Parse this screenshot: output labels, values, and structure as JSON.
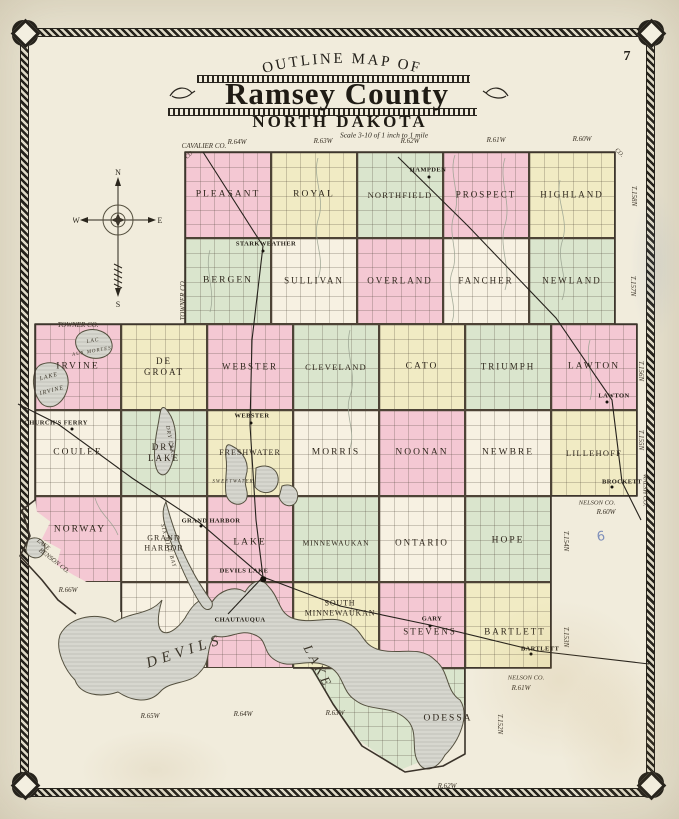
{
  "header": {
    "page_number": "7",
    "arc_title": "OUTLINE MAP OF",
    "title": "Ramsey County",
    "subtitle": "NORTH DAKOTA",
    "scale": "Scale 3-10 of 1 inch to 1 mile"
  },
  "compass": {
    "north": "N",
    "south": "S",
    "east": "E",
    "west": "W"
  },
  "colors": {
    "pink": "#f4c8d3",
    "yellow": "#f1ebc4",
    "green": "#dae5cd",
    "cream": "#f7f1e2",
    "lake_fill": "#d7d7cf",
    "lake_edge": "#54503f",
    "rail": "#26221c",
    "creek": "#96a08e",
    "boundary": "#3a332a",
    "ink": "#2f271c",
    "pencil_blue": "#6b7fb5"
  },
  "clips": {
    "norway": "polygon(0% 0%,100% 0%,100% 100%,60% 100%,45% 92%,25% 80%,30% 62%,8% 50%,18% 30%,2% 18%)",
    "odessa": "polygon(0% 0%,100% 0%,100% 35%,84% 84%,58% 100%,32% 71%,13% 31%)"
  },
  "townships": [
    {
      "n": "PLEASANT",
      "x": 185,
      "y": 152,
      "w": 86,
      "h": 86,
      "c": "pink"
    },
    {
      "n": "ROYAL",
      "x": 271,
      "y": 152,
      "w": 86,
      "h": 86,
      "c": "yellow"
    },
    {
      "n": "NORTHFIELD",
      "x": 357,
      "y": 152,
      "w": 86,
      "h": 86,
      "c": "green",
      "fs": 8.5,
      "sp": 1.2
    },
    {
      "n": "PROSPECT",
      "x": 443,
      "y": 152,
      "w": 86,
      "h": 86,
      "c": "pink",
      "fs": 9
    },
    {
      "n": "HIGHLAND",
      "x": 529,
      "y": 152,
      "w": 86,
      "h": 86,
      "c": "yellow",
      "fs": 9
    },
    {
      "n": "BERGEN",
      "x": 185,
      "y": 238,
      "w": 86,
      "h": 86,
      "c": "green"
    },
    {
      "n": "SULLIVAN",
      "x": 271,
      "y": 238,
      "w": 86,
      "h": 86,
      "c": "cream",
      "fs": 9
    },
    {
      "n": "OVERLAND",
      "x": 357,
      "y": 238,
      "w": 86,
      "h": 86,
      "c": "pink",
      "fs": 9
    },
    {
      "n": "FANCHER",
      "x": 443,
      "y": 238,
      "w": 86,
      "h": 86,
      "c": "cream",
      "fs": 9
    },
    {
      "n": "NEWLAND",
      "x": 529,
      "y": 238,
      "w": 86,
      "h": 86,
      "c": "green",
      "fs": 9
    },
    {
      "n": "IRVINE",
      "x": 35,
      "y": 324,
      "w": 86,
      "h": 86,
      "c": "pink"
    },
    {
      "n": "DE GROAT",
      "x": 121,
      "y": 324,
      "w": 86,
      "h": 86,
      "c": "yellow",
      "fs": 9
    },
    {
      "n": "WEBSTER",
      "x": 207,
      "y": 324,
      "w": 86,
      "h": 86,
      "c": "pink",
      "fs": 9
    },
    {
      "n": "CLEVELAND",
      "x": 293,
      "y": 324,
      "w": 86,
      "h": 86,
      "c": "green",
      "fs": 8.5,
      "sp": 1.2
    },
    {
      "n": "CATO",
      "x": 379,
      "y": 324,
      "w": 86,
      "h": 86,
      "c": "yellow"
    },
    {
      "n": "TRIUMPH",
      "x": 465,
      "y": 324,
      "w": 86,
      "h": 86,
      "c": "green",
      "fs": 9
    },
    {
      "n": "LAWTON",
      "x": 551,
      "y": 324,
      "w": 86,
      "h": 86,
      "c": "pink"
    },
    {
      "n": "COULEE",
      "x": 35,
      "y": 410,
      "w": 86,
      "h": 86,
      "c": "cream"
    },
    {
      "n": "DRY LAKE",
      "x": 121,
      "y": 410,
      "w": 86,
      "h": 86,
      "c": "green",
      "fs": 9
    },
    {
      "n": "FRESHWATER",
      "x": 207,
      "y": 410,
      "w": 86,
      "h": 86,
      "c": "yellow",
      "fs": 8,
      "sp": 1
    },
    {
      "n": "MORRIS",
      "x": 293,
      "y": 410,
      "w": 86,
      "h": 86,
      "c": "cream"
    },
    {
      "n": "NOONAN",
      "x": 379,
      "y": 410,
      "w": 86,
      "h": 86,
      "c": "pink"
    },
    {
      "n": "NEWBRE",
      "x": 465,
      "y": 410,
      "w": 86,
      "h": 86,
      "c": "cream"
    },
    {
      "n": "LILLEHOFF",
      "x": 551,
      "y": 410,
      "w": 86,
      "h": 86,
      "c": "yellow",
      "fs": 8.5,
      "sp": 1.2
    },
    {
      "n": "NORWAY",
      "x": 35,
      "y": 496,
      "w": 86,
      "h": 86,
      "c": "pink",
      "clip": "norway",
      "lx": 80,
      "ly": 530
    },
    {
      "n": "GRAND HARBOR",
      "x": 121,
      "y": 496,
      "w": 86,
      "h": 86,
      "c": "cream",
      "fs": 8,
      "sp": 1,
      "ly": 543
    },
    {
      "n": "LAKE",
      "x": 207,
      "y": 496,
      "w": 86,
      "h": 86,
      "c": "pink",
      "ly": 543
    },
    {
      "n": "MINNEWAUKAN",
      "x": 293,
      "y": 496,
      "w": 86,
      "h": 86,
      "c": "green",
      "fs": 7.5,
      "sp": 0.8,
      "ly": 543
    },
    {
      "n": "ONTARIO",
      "x": 379,
      "y": 496,
      "w": 86,
      "h": 86,
      "c": "cream",
      "fs": 9,
      "ly": 543
    },
    {
      "n": "HOPE",
      "x": 465,
      "y": 496,
      "w": 86,
      "h": 86,
      "c": "green",
      "ly": 541
    },
    {
      "n": "",
      "x": 121,
      "y": 582,
      "w": 86,
      "h": 86,
      "c": "cream"
    },
    {
      "n": "",
      "x": 207,
      "y": 582,
      "w": 86,
      "h": 86,
      "c": "pink"
    },
    {
      "n": "SOUTH\nMINNEWAUKAN",
      "x": 293,
      "y": 582,
      "w": 86,
      "h": 86,
      "c": "yellow",
      "fs": 8,
      "sp": 0.8,
      "lx": 340,
      "ly": 608
    },
    {
      "n": "STEVENS",
      "x": 379,
      "y": 582,
      "w": 86,
      "h": 86,
      "c": "pink",
      "fs": 9,
      "lx": 430,
      "ly": 632
    },
    {
      "n": "BARTLETT",
      "x": 465,
      "y": 582,
      "w": 86,
      "h": 86,
      "c": "yellow",
      "fs": 9,
      "lx": 515,
      "ly": 632
    },
    {
      "n": "ODESSA",
      "x": 310,
      "y": 668,
      "w": 155,
      "h": 102,
      "c": "green",
      "clip": "odessa",
      "lx": 448,
      "ly": 719
    }
  ],
  "edge_labels": [
    {
      "t": "CAVALIER CO.",
      "x": 204,
      "y": 146
    },
    {
      "t": "R.64W",
      "x": 237,
      "y": 142
    },
    {
      "t": "R.63W",
      "x": 323,
      "y": 141
    },
    {
      "t": "R.62W",
      "x": 410,
      "y": 141
    },
    {
      "t": "R.61W",
      "x": 496,
      "y": 140
    },
    {
      "t": "R.60W",
      "x": 582,
      "y": 139
    },
    {
      "t": "CO.",
      "x": 190,
      "y": 155,
      "r": -45,
      "s": 6
    },
    {
      "t": "CO.",
      "x": 619,
      "y": 153,
      "r": 45,
      "s": 6
    },
    {
      "t": "T.158N",
      "x": 634,
      "y": 196,
      "r": 90
    },
    {
      "t": "T.157N",
      "x": 633,
      "y": 286,
      "r": 90
    },
    {
      "t": "T.156N",
      "x": 641,
      "y": 371,
      "r": 90
    },
    {
      "t": "T.155N",
      "x": 641,
      "y": 440,
      "r": 90
    },
    {
      "t": "WALSH CO.",
      "x": 645,
      "y": 490,
      "r": 90,
      "s": 6.5
    },
    {
      "t": "NELSON CO.",
      "x": 597,
      "y": 503,
      "s": 6.5
    },
    {
      "t": "R.60W",
      "x": 606,
      "y": 512
    },
    {
      "t": "T.154N",
      "x": 566,
      "y": 541,
      "r": 90
    },
    {
      "t": "T.153N",
      "x": 566,
      "y": 637,
      "r": 90
    },
    {
      "t": "NELSON CO.",
      "x": 526,
      "y": 678,
      "s": 6.5
    },
    {
      "t": "R.61W",
      "x": 521,
      "y": 688
    },
    {
      "t": "T.152N",
      "x": 500,
      "y": 724,
      "r": 90
    },
    {
      "t": "R.62W",
      "x": 447,
      "y": 786
    },
    {
      "t": "R.65W",
      "x": 150,
      "y": 716
    },
    {
      "t": "R.64W",
      "x": 243,
      "y": 714
    },
    {
      "t": "R.63W",
      "x": 335,
      "y": 713
    },
    {
      "t": "TOWNER CO.",
      "x": 183,
      "y": 300,
      "r": -90
    },
    {
      "t": "TOWNER CO.",
      "x": 78,
      "y": 325
    },
    {
      "t": "LAKE",
      "x": 43,
      "y": 545,
      "r": 38,
      "s": 6
    },
    {
      "t": "BENSON CO.",
      "x": 54,
      "y": 561,
      "r": 38,
      "s": 6.5
    },
    {
      "t": "R.66W",
      "x": 68,
      "y": 590
    }
  ],
  "towns": [
    {
      "n": "HAMPDEN",
      "x": 428,
      "y": 170,
      "dx": 429,
      "dy": 177
    },
    {
      "n": "STARKWEATHER",
      "x": 266,
      "y": 244,
      "dx": 263,
      "dy": 251
    },
    {
      "n": "CHURCH'S FERRY",
      "x": 56,
      "y": 423,
      "dx": 72,
      "dy": 429
    },
    {
      "n": "WEBSTER",
      "x": 252,
      "y": 416,
      "dx": 251,
      "dy": 423
    },
    {
      "n": "GRAND HARBOR",
      "x": 211,
      "y": 521,
      "dx": 201,
      "dy": 526
    },
    {
      "n": "DEVILS LAKE",
      "x": 244,
      "y": 571,
      "dx": 263,
      "dy": 579,
      "big": true
    },
    {
      "n": "LAWTON",
      "x": 614,
      "y": 396,
      "dx": 607,
      "dy": 402
    },
    {
      "n": "BROCKETT",
      "x": 622,
      "y": 482,
      "dx": 612,
      "dy": 487
    },
    {
      "n": "GARY",
      "x": 432,
      "y": 619,
      "dx": 430,
      "dy": 626
    },
    {
      "n": "BARTLETT",
      "x": 540,
      "y": 649,
      "dx": 531,
      "dy": 654
    },
    {
      "n": "CHAUTAUQUA",
      "x": 240,
      "y": 620
    }
  ],
  "lake_labels": [
    {
      "t": "DEVILS",
      "x": 185,
      "y": 652,
      "r": -18,
      "s": 15,
      "sp": 5
    },
    {
      "t": "LAKE",
      "x": 318,
      "y": 667,
      "r": 62,
      "s": 13,
      "sp": 4
    },
    {
      "t": "SIX MILE BAY",
      "x": 168,
      "y": 546,
      "r": 74,
      "s": 5.5
    },
    {
      "t": "DRY LAKE",
      "x": 170,
      "y": 442,
      "r": 80,
      "s": 5.5
    },
    {
      "t": "SWEETWATER",
      "x": 233,
      "y": 482,
      "s": 5
    },
    {
      "t": "LAKE",
      "x": 49,
      "y": 377,
      "r": -15,
      "s": 6
    },
    {
      "t": "IRVINE",
      "x": 52,
      "y": 391,
      "r": -15,
      "s": 6
    },
    {
      "t": "LAC",
      "x": 93,
      "y": 341,
      "r": -10,
      "s": 5.5
    },
    {
      "t": "AUX MORTES",
      "x": 92,
      "y": 352,
      "r": -10,
      "s": 5
    }
  ],
  "annotation": {
    "t": "6",
    "x": 601,
    "y": 537
  },
  "water": {
    "lakes": [
      {
        "id": "devils-lake-shape",
        "d": "M60,635 C70,615 100,612 115,622 C130,612 150,615 162,600 C150,640 170,640 185,618 C195,600 205,595 212,602 C220,590 235,585 245,592 C252,580 262,578 268,586 C280,598 278,612 292,618 C310,625 330,615 345,622 C365,630 360,645 380,650 C400,655 420,645 435,660 C450,672 445,690 460,700 C470,715 460,740 445,755 C438,768 425,775 418,762 C410,748 420,730 405,718 C390,705 370,712 355,700 C340,690 345,672 325,665 C305,658 290,670 275,660 C262,652 268,640 255,635 C240,628 230,640 215,636 C205,648 212,660 200,672 C190,685 170,680 160,692 C148,705 130,700 118,692 C100,698 80,695 75,680 C65,670 55,650 60,635 Z"
      },
      {
        "id": "six-mile-bay-shape",
        "d": "M166,502 C172,525 180,548 192,570 C198,582 205,592 212,602 C214,610 206,612 202,606 C192,592 182,570 172,545 C164,525 160,512 166,502 Z"
      },
      {
        "id": "lake-irvine-shape",
        "d": "M40,365 C55,358 70,368 68,385 C66,402 52,412 42,404 C32,394 30,372 40,365 Z"
      },
      {
        "id": "lac-aux-mortes-shape",
        "d": "M82,332 C95,326 110,332 112,344 C114,356 98,362 86,356 C74,350 72,338 82,332 Z"
      },
      {
        "id": "dry-lake-shape",
        "d": "M165,408 C175,418 178,435 174,455 C171,470 165,480 158,472 C152,462 155,440 158,425 C160,415 160,405 165,408 Z"
      },
      {
        "id": "sweetwater-lake-shape",
        "d": "M232,446 C244,452 250,464 246,476 C243,486 250,492 246,500 C240,508 228,504 226,494 C224,482 228,470 226,458 C225,448 226,442 232,446 Z"
      },
      {
        "id": "small-lake-shape",
        "d": "M256,468 C268,462 280,470 278,482 C276,494 262,496 255,487 Z"
      },
      {
        "id": "small-lake-shape",
        "d": "M282,486 C292,482 300,490 297,500 C294,509 282,507 279,497 Z"
      },
      {
        "id": "boundary-lake-shape",
        "d": "M28,540 C38,534 48,542 44,552 C40,562 26,558 26,549 Z"
      }
    ],
    "creeks": [
      "M455,155 C448,175 462,195 454,215 C447,235 460,252 452,272 C446,290 458,305 452,322",
      "M318,158 C312,178 326,198 318,220 C312,240 326,258 318,278",
      "M505,158 C498,180 512,202 505,225 C498,248 512,268 505,290",
      "M350,330 C344,352 358,374 350,396 C344,414 356,430 350,448",
      "M210,250 C204,270 216,290 210,312",
      "M560,180 C555,200 570,220 562,242 C556,262 570,280 562,300",
      "M590,340 C584,360 596,380 590,400",
      "M95,498 C100,515 112,520 118,535"
    ]
  },
  "railroads": [
    "M203,152 L263,246 L252,340 L250,425 L256,520 L263,577",
    "M398,157 L468,226 L556,318 L612,400 L622,482 L641,520",
    "M18,404 L58,424 L132,478 L200,523 L263,577",
    "M263,577 L340,606 L430,625 L537,651 L649,664",
    "M263,577 L243,598 L228,614"
  ],
  "county_outline": [
    "M185,324 L185,152 L615,152 L615,324 L637,324 L637,496 L551,496 L551,668 L465,668 L465,754 L443,766 L405,772 L362,746 L333,704 L312,668 L293,668",
    "M185,324 L35,324 L35,500 L22,510 L30,536 L20,556 L42,580 L58,600 L76,614",
    "M121,582 L121,612"
  ]
}
